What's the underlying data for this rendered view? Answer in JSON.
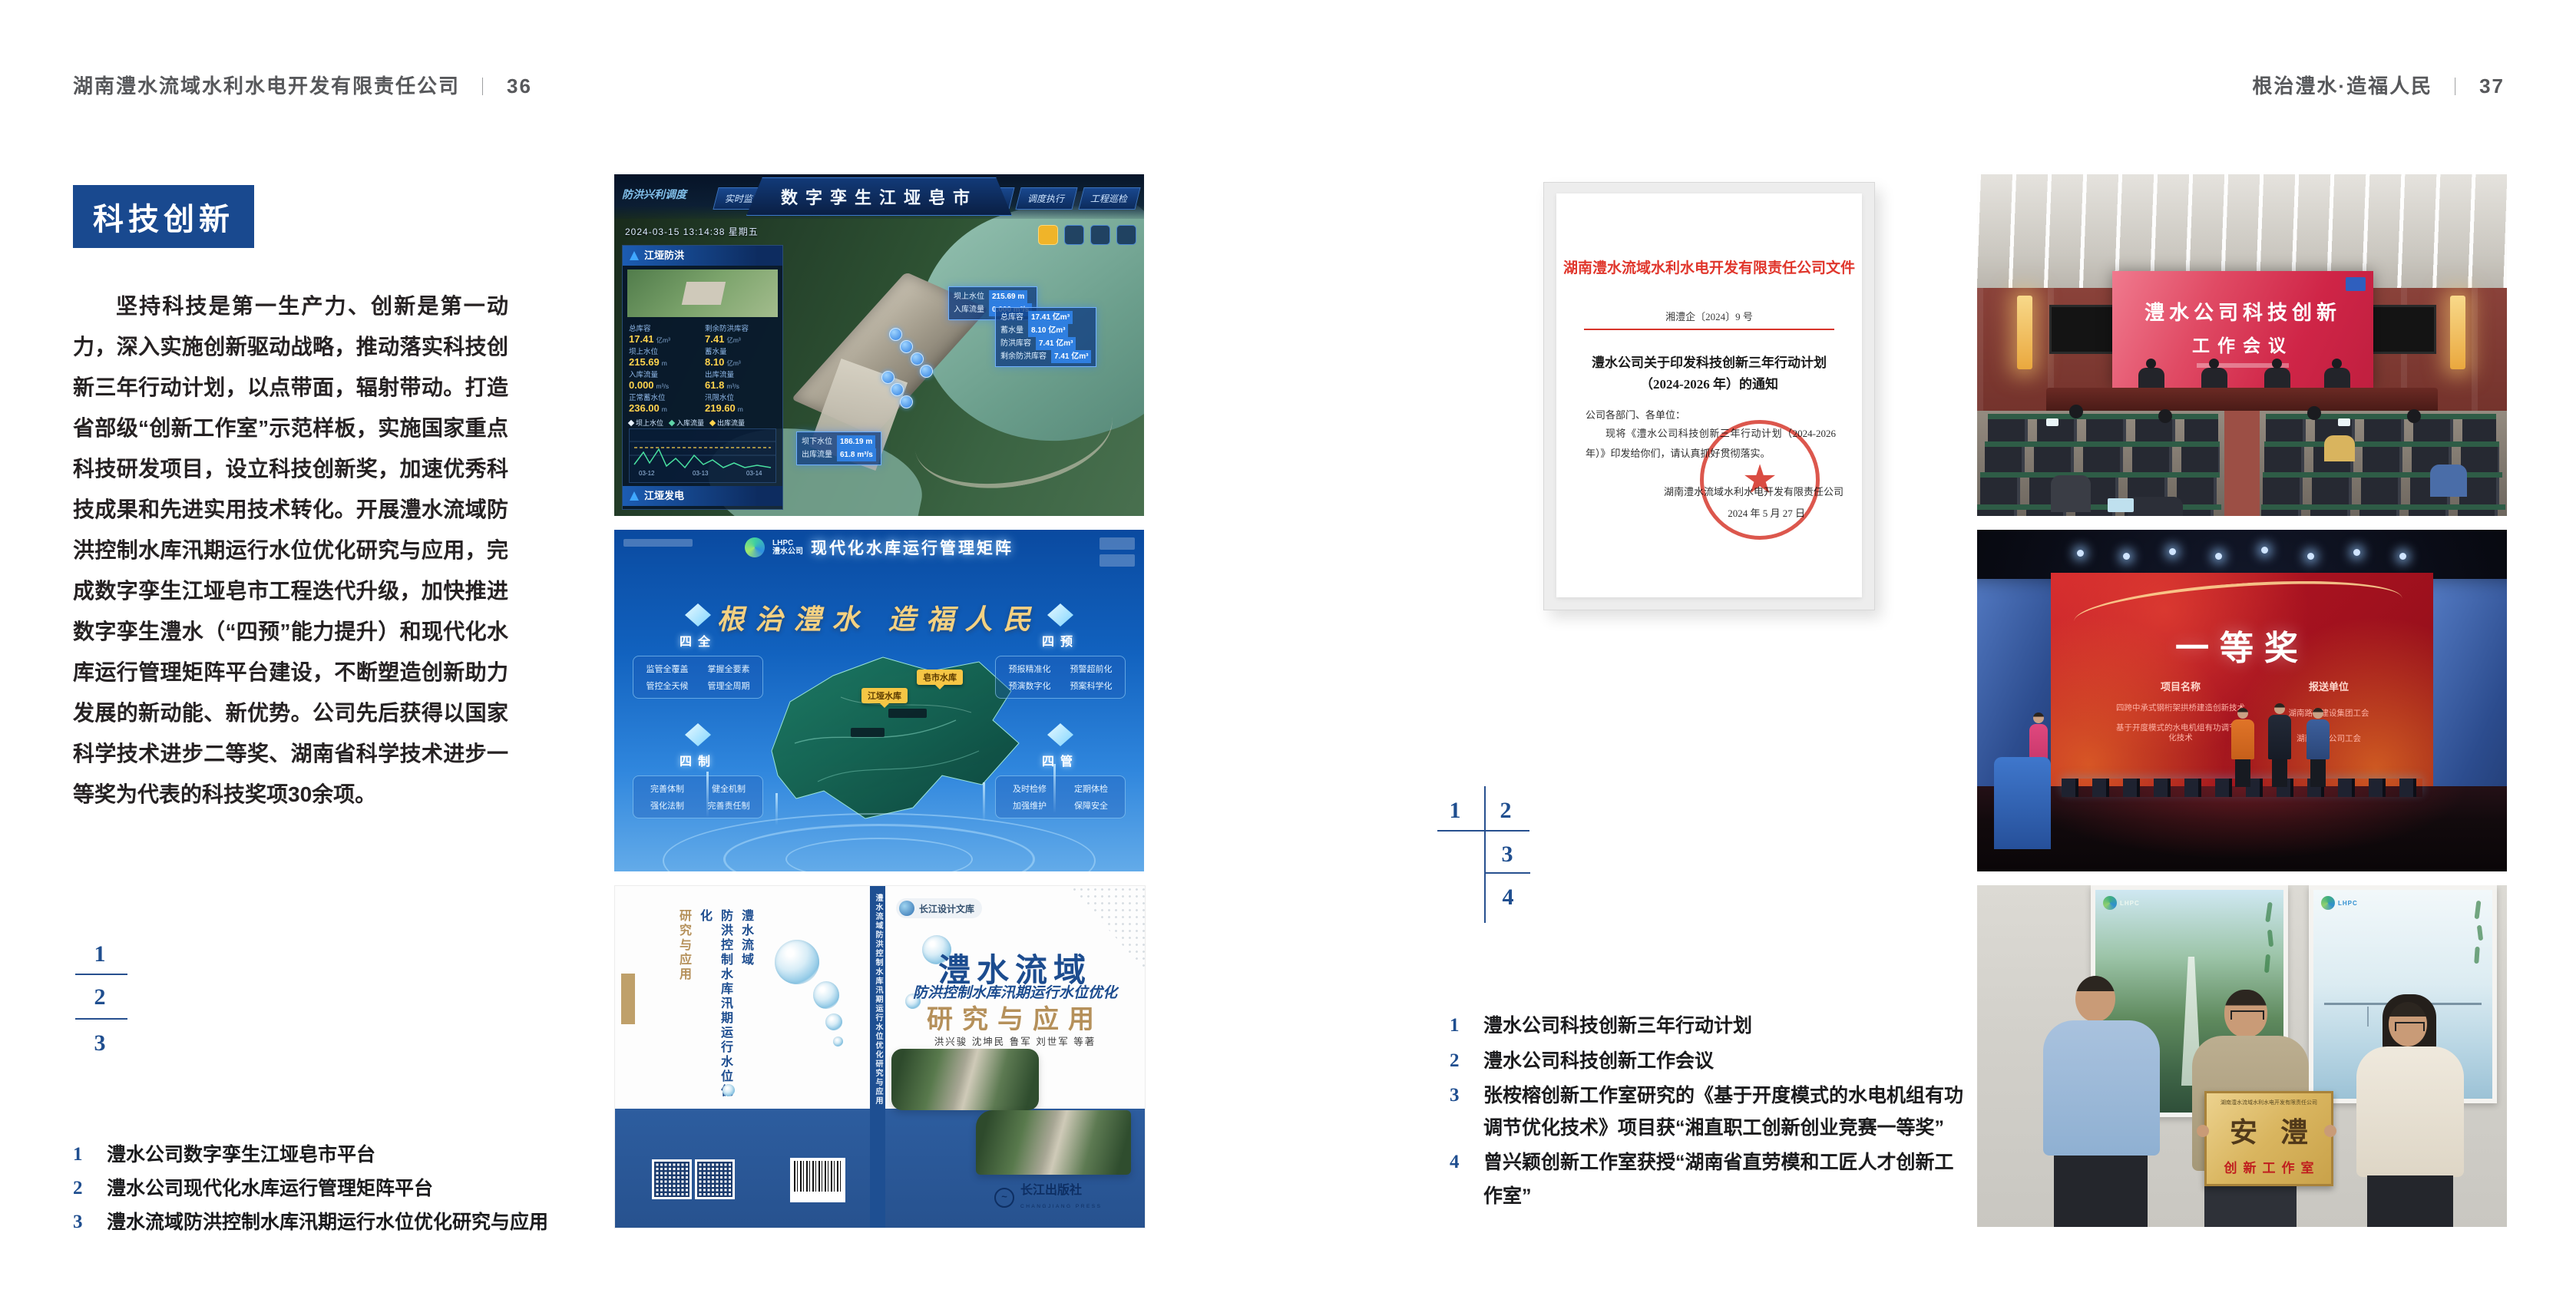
{
  "page_left": {
    "header": {
      "company": "湖南澧水流域水利水电开发有限责任公司",
      "divider": "｜",
      "page_number": "36"
    },
    "section_badge": "科技创新",
    "body_paragraph": "坚持科技是第一生产力、创新是第一动力，深入实施创新驱动战略，推动落实科技创新三年行动计划，以点带面，辐射带动。打造省部级“创新工作室”示范样板，实施国家重点科技研发项目，设立科技创新奖，加速优秀科技成果和先进实用技术转化。开展澧水流域防洪控制水库汛期运行水位优化研究与应用，完成数字孪生江垭皂市工程迭代升级，加快推进数字孪生澧水（“四预”能力提升）和现代化水库运行管理矩阵平台建设，不断塑造创新助力发展的新动能、新优势。公司先后获得以国家科学技术进步二等奖、湖南省科学技术进步一等奖为代表的科技奖项30余项。",
    "figure_index": [
      "1",
      "2",
      "3"
    ],
    "captions": [
      {
        "num": "1",
        "text": "澧水公司数字孪生江垭皂市平台"
      },
      {
        "num": "2",
        "text": "澧水公司现代化水库运行管理矩阵平台"
      },
      {
        "num": "3",
        "text": "澧水流域防洪控制水库汛期运行水位优化研究与应用"
      }
    ]
  },
  "page_right": {
    "header": {
      "slogan": "根治澧水·造福人民",
      "divider": "｜",
      "page_number": "37"
    },
    "figure_index": [
      "1",
      "2",
      "3",
      "4"
    ],
    "captions": [
      {
        "num": "1",
        "text": "澧水公司科技创新三年行动计划"
      },
      {
        "num": "2",
        "text": "澧水公司科技创新工作会议"
      },
      {
        "num": "3",
        "text": "张桉榕创新工作室研究的《基于开度模式的水电机组有功调节优化技术》项目获“湘直职工创新创业竞赛一等奖”"
      },
      {
        "num": "4",
        "text": "曾兴颖创新工作室获授“湖南省直劳模和工匠人才创新工作室”"
      }
    ]
  },
  "figures": {
    "digital_twin": {
      "title": "数字孪生江垭皂市",
      "corner_label": "防洪兴利调度",
      "timestamp": "2024-03-15 13:14:38 星期五",
      "tabs_left": [
        "实时监测",
        "洪水预报",
        "防洪预警"
      ],
      "tabs_right": [
        "态势预测",
        "预案生成",
        "调度执行",
        "工程巡检"
      ],
      "panel_flood": {
        "title": "江垭防洪",
        "stats": [
          {
            "label": "总库容",
            "value": "17.41",
            "unit": "亿m³"
          },
          {
            "label": "剩余防洪库容",
            "value": "7.41",
            "unit": "亿m³"
          },
          {
            "label": "坝上水位",
            "value": "215.69",
            "unit": "m"
          },
          {
            "label": "蓄水量",
            "value": "8.10",
            "unit": "亿m³"
          },
          {
            "label": "入库流量",
            "value": "0.000",
            "unit": "m³/s"
          },
          {
            "label": "出库流量",
            "value": "61.8",
            "unit": "m³/s"
          },
          {
            "label": "正常蓄水位",
            "value": "236.00",
            "unit": "m"
          },
          {
            "label": "汛限水位",
            "value": "219.60",
            "unit": "m"
          }
        ]
      },
      "chart_legend": [
        "坝上水位",
        "入库流量",
        "出库流量"
      ],
      "chart_ticks": [
        "03-12",
        "03-13",
        "03-14"
      ],
      "panel_power": {
        "title": "江垭发电",
        "stats": [
          {
            "label": "年发电计划",
            "value": "6.3000",
            "unit": "亿kWh"
          },
          {
            "label": "年累计发电量",
            "value": "1.2907",
            "unit": "亿kWh"
          },
          {
            "label": "月累计发电量",
            "value": "3359.21",
            "unit": "万kWh"
          },
          {
            "label": "当前出力",
            "value": "0.00",
            "unit": "MW"
          },
          {
            "label": "发电流量",
            "value": "0.00",
            "unit": "m³/s"
          },
          {
            "label": "弃水流量",
            "value": "0.00",
            "unit": "m³/s"
          }
        ]
      },
      "tooltip_up": [
        [
          "坝上水位",
          "215.69 m"
        ],
        [
          "入库流量",
          "0.000 m³/s"
        ]
      ],
      "tooltip_res": [
        [
          "总库容",
          "17.41 亿m³"
        ],
        [
          "蓄水量",
          "8.10 亿m³"
        ],
        [
          "防洪库容",
          "7.41 亿m³"
        ],
        [
          "剩余防洪库容",
          "7.41 亿m³"
        ]
      ],
      "tooltip_down": [
        [
          "坝下水位",
          "186.19 m"
        ],
        [
          "出库流量",
          "61.8 m³/s"
        ]
      ]
    },
    "matrix_platform": {
      "brand_en": "LHPC",
      "brand_cn": "澧水公司",
      "title": "现代化水库运行管理矩阵",
      "slogan": "根治澧水  造福人民",
      "map_labels": [
        "皂市水库",
        "江垭水库"
      ],
      "panels": [
        {
          "title": "四全",
          "items": [
            "监管全覆盖",
            "掌握全要素",
            "管控全天候",
            "管理全周期"
          ]
        },
        {
          "title": "四预",
          "items": [
            "预报精准化",
            "预警超前化",
            "预演数字化",
            "预案科学化"
          ]
        },
        {
          "title": "四制",
          "items": [
            "完善体制",
            "健全机制",
            "强化法制",
            "完善责任制"
          ]
        },
        {
          "title": "四管",
          "items": [
            "及时检修",
            "定期体检",
            "加强维护",
            "保障安全"
          ]
        }
      ]
    },
    "book_cover": {
      "series_badge": "长江设计文库",
      "title_main": "澧水流域",
      "title_sub": "防洪控制水库汛期运行水位优化",
      "title_tail": "研究与应用",
      "authors": "洪兴骏  沈坤民  鲁军  刘世军  等著",
      "publisher": "长江出版社",
      "publisher_en": "CHANGJIANG PRESS",
      "publisher_mark": "~",
      "spine_text": "澧水流域防洪控制水库汛期运行水位优化研究与应用",
      "back_title_line1": "澧水流域",
      "back_title_line2": "防洪控制水库汛期运行水位优化",
      "back_title_line3": "研究与应用"
    },
    "document": {
      "header": "湖南澧水流域水利水电开发有限责任公司文件",
      "doc_number": "湘澧企〔2024〕9 号",
      "title_line1": "澧水公司关于印发科技创新三年行动计划",
      "title_line2": "（2024-2026 年）的通知",
      "salutation": "公司各部门、各单位：",
      "body": "现将《澧水公司科技创新三年行动计划（2024-2026 年）》印发给你们，请认真抓好贯彻落实。",
      "signoff": "湖南澧水流域水利水电开发有限责任公司",
      "date": "2024 年 5 月 27 日",
      "seal_star": "★"
    },
    "meeting_photo": {
      "screen_line1": "澧水公司科技创新",
      "screen_line2": "工作会议"
    },
    "award_photo": {
      "screen_title": "一等奖",
      "col1_header": "项目名称",
      "col2_header": "报送单位",
      "rows": [
        [
          "四跨中承式钢桁架拱桥建造创新技术",
          "湖南路桥建设集团工会"
        ],
        [
          "基于开度模式的水电机组有功调节优化技术",
          "湖南澧水公司工会"
        ]
      ]
    },
    "plaque_photo": {
      "poster_logo": "LHPC",
      "plaque_header": "湖南澧水流域水利水电开发有限责任公司",
      "plaque_title": "安澧",
      "plaque_subtitle": "创新工作室"
    }
  },
  "colors": {
    "accent_blue": "#19498f",
    "index_blue": "#1f4e8f",
    "doc_red": "#e0362c",
    "band_blue": "#2d5d9f"
  }
}
